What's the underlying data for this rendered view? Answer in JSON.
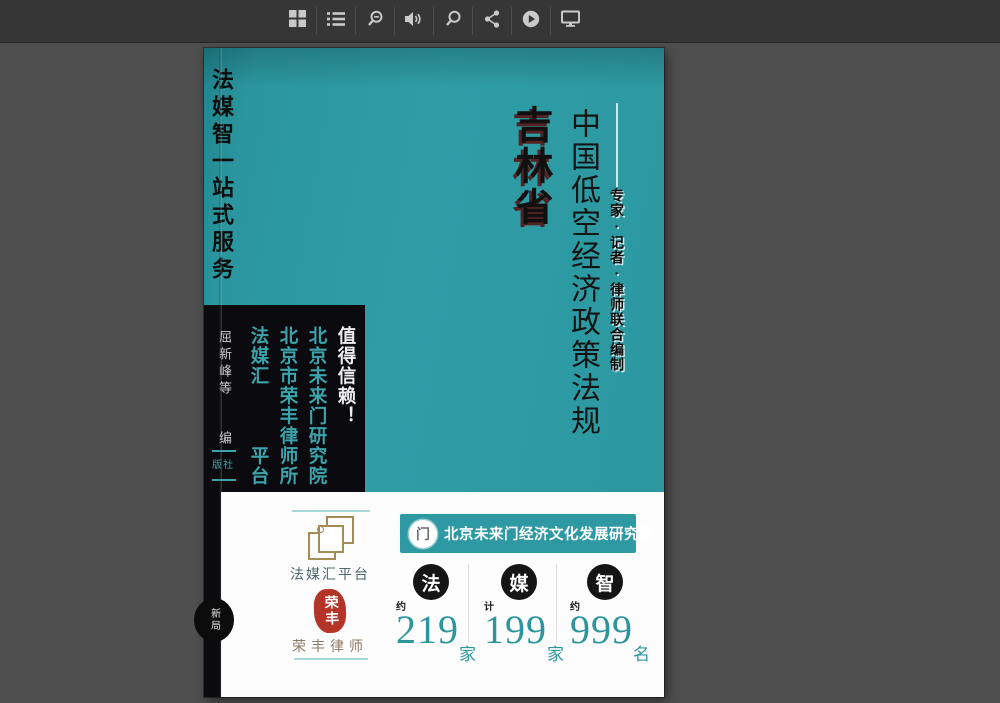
{
  "toolbar": {
    "icons": [
      {
        "name": "thumbnail-grid"
      },
      {
        "name": "table-of-contents"
      },
      {
        "name": "zoom-out"
      },
      {
        "name": "sound"
      },
      {
        "name": "zoom-in"
      },
      {
        "name": "share"
      },
      {
        "name": "autoplay"
      },
      {
        "name": "fullscreen"
      }
    ]
  },
  "cover": {
    "spine_service_text": "法媒智一站式服务",
    "province": "吉林省",
    "title": "中国低空经济政策法规",
    "byline": "专家·记者·律师联合编制",
    "editors": "屈新峰等",
    "editor_role": "编",
    "publisher_partial": "版社",
    "spine_badge": "新局",
    "trust_box": {
      "col_trust": "值得信赖！",
      "col_institute": "北京未来门研究院",
      "col_lawfirm": "北京市荣丰律师所",
      "col_platform": "法媒汇　　　平台"
    },
    "colors": {
      "cover_teal": "#2d99a2",
      "box_black": "#0b0b0f",
      "box_text_teal": "#3ba3ab",
      "province_shadow_red": "#581616"
    }
  },
  "footer": {
    "platform_logo_label": "法媒汇平台",
    "seal_text": "荣丰",
    "lawyer_label": "荣丰律师",
    "banner": {
      "text": "北京未来门经济文化发展研究院",
      "logo_glyph": "门"
    },
    "stats": [
      {
        "circle": "法",
        "qualifier": "约",
        "value": "219",
        "unit": "家"
      },
      {
        "circle": "媒",
        "qualifier": "计",
        "value": "199",
        "unit": "家"
      },
      {
        "circle": "智",
        "qualifier": "约",
        "value": "999",
        "unit": "名"
      }
    ],
    "accent_teal": "#2c959e"
  }
}
